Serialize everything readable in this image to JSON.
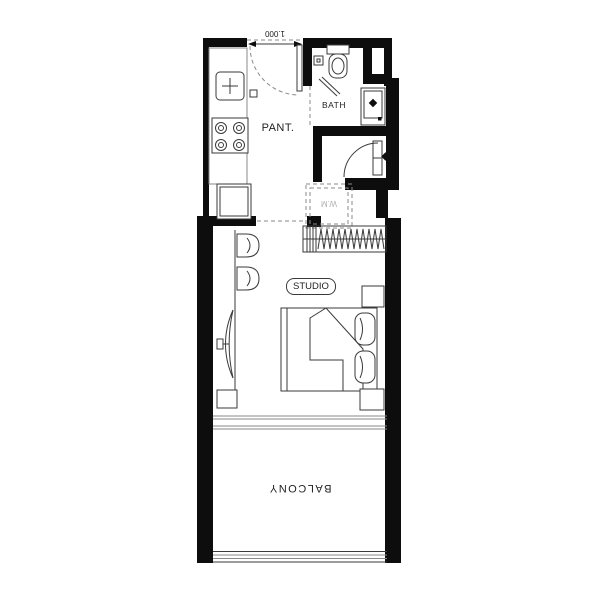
{
  "plan": {
    "labels": {
      "pantry": "PANT.",
      "bath": "BATH",
      "studio": "STUDIO",
      "balcony": "BALCONY",
      "washing_machine": "W.M",
      "entry_width_dimension": "1.000"
    },
    "fixtures": [
      "kitchen-sink",
      "stove-4-burner",
      "fridge",
      "kitchen-counter",
      "toilet",
      "floor-drain",
      "shower-screen",
      "wash-basin",
      "entry-door-swing",
      "foyer-door-swing",
      "washing-machine-box",
      "wardrobe-hanging-rail",
      "bar-stool",
      "bar-stool",
      "wall-tv",
      "tv-console",
      "double-bed",
      "duvet",
      "pillow",
      "pillow",
      "nightstand",
      "nightstand",
      "sliding-glass-door",
      "balcony-railing"
    ],
    "colors": {
      "bg": "#ffffff",
      "wall": "#0d0d0d",
      "line": "#3a3a3a",
      "light_line": "#8a8a8a",
      "muted_text": "#b0b0b0",
      "text": "#1f1f1f"
    }
  }
}
